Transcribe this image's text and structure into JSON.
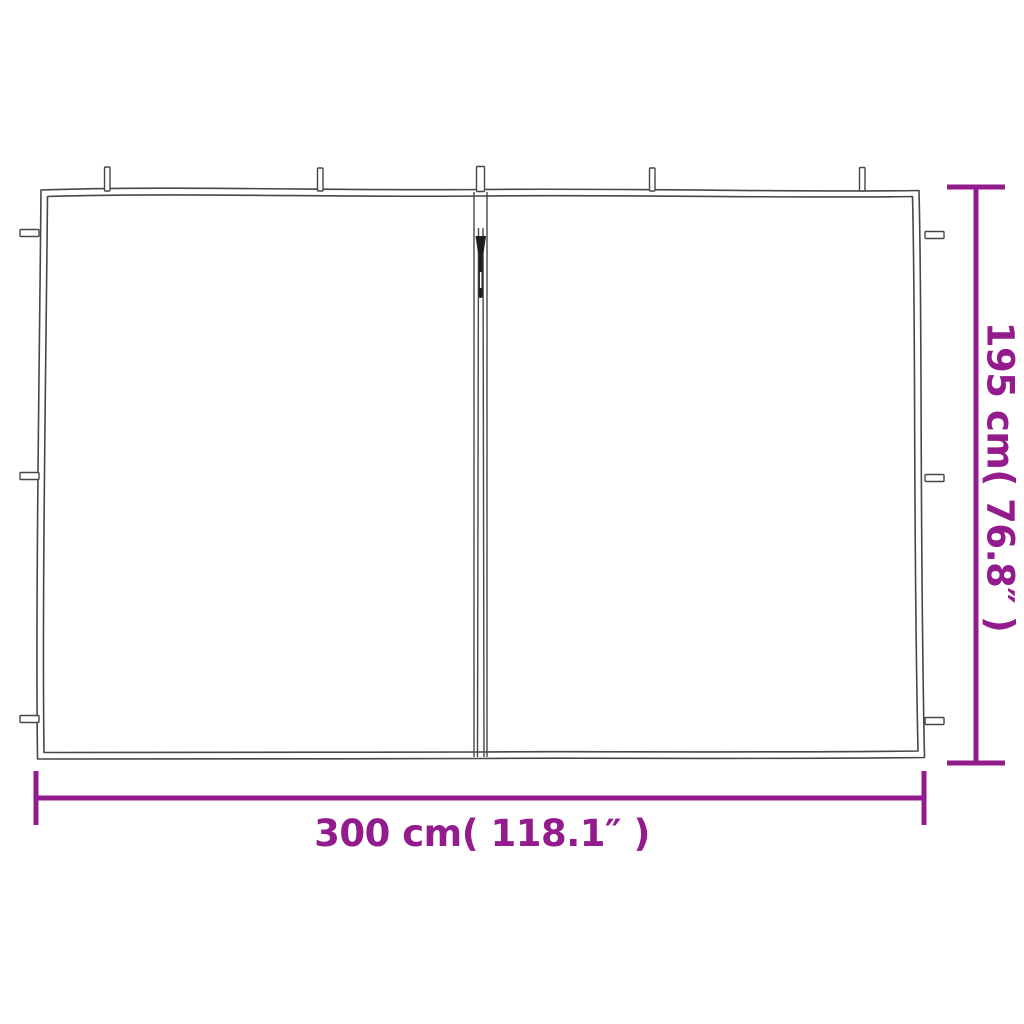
{
  "diagram": {
    "subject": "gazebo-sidewall-with-zipper-dimension-diagram",
    "dimensions": {
      "width_label": "300 cm( 118.1″ )",
      "height_label": "195 cm( 76.8″ )"
    },
    "colors": {
      "dimension_accent": "#941b8d",
      "outline": "#474747",
      "background": "#ffffff"
    }
  }
}
